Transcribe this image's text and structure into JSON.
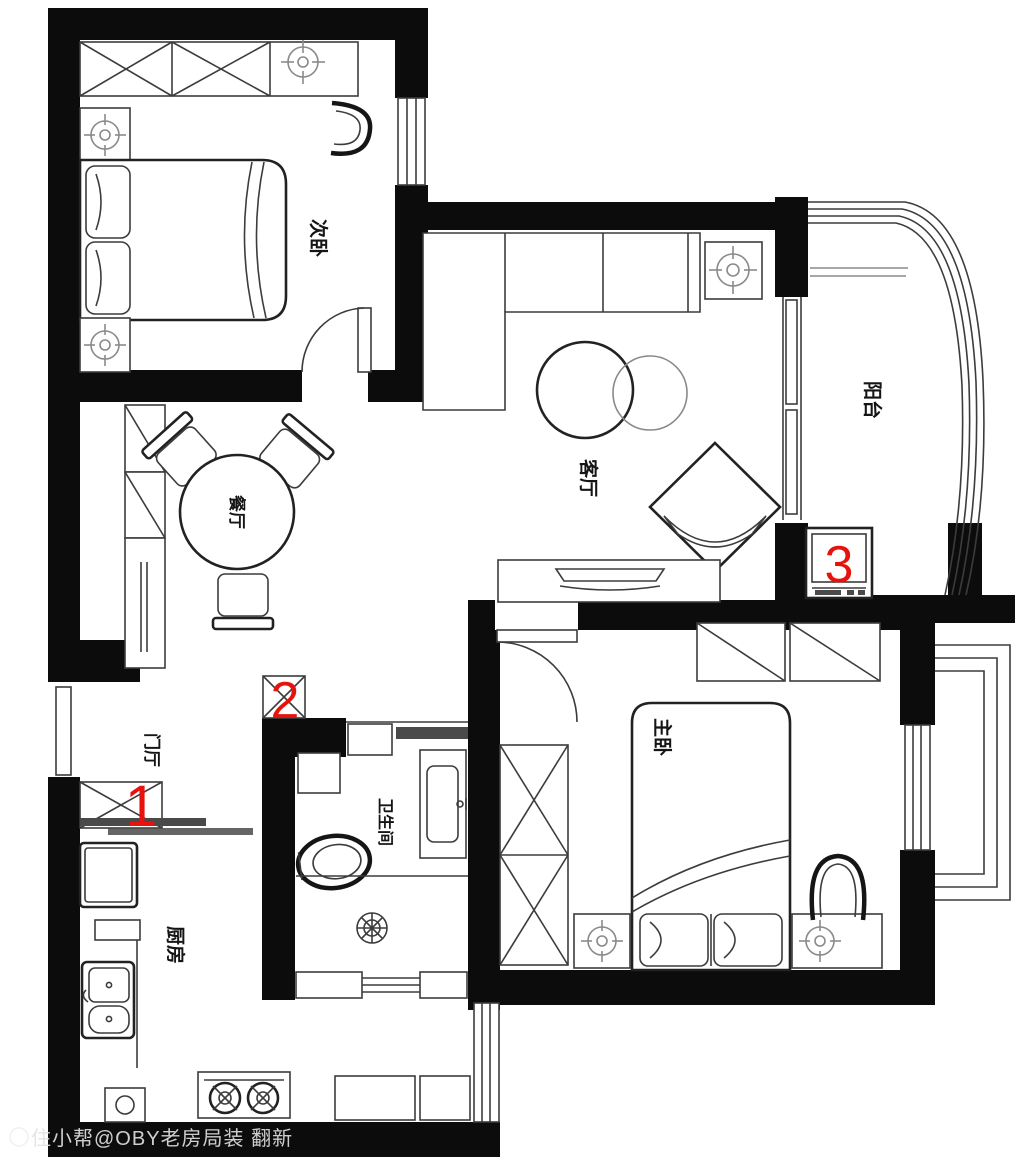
{
  "rooms": {
    "secondary_bedroom": {
      "label": "次卧"
    },
    "living_room": {
      "label": "客厅"
    },
    "balcony": {
      "label": "阳台"
    },
    "dining_room": {
      "label": "餐厅"
    },
    "entry_hall": {
      "label": "门厅"
    },
    "kitchen": {
      "label": "厨房"
    },
    "bathroom": {
      "label": "卫生间"
    },
    "master_bedroom": {
      "label": "主卧"
    }
  },
  "markers": {
    "m1": "1",
    "m2": "2",
    "m3": "3"
  },
  "watermark": {
    "text": "住小帮@OBY老房局装 翻新"
  },
  "colors": {
    "wall": "#0c0c0c",
    "line": "#3c3c3c",
    "marker_red": "#e8120c",
    "light_symbol": "#8a8a8a"
  }
}
